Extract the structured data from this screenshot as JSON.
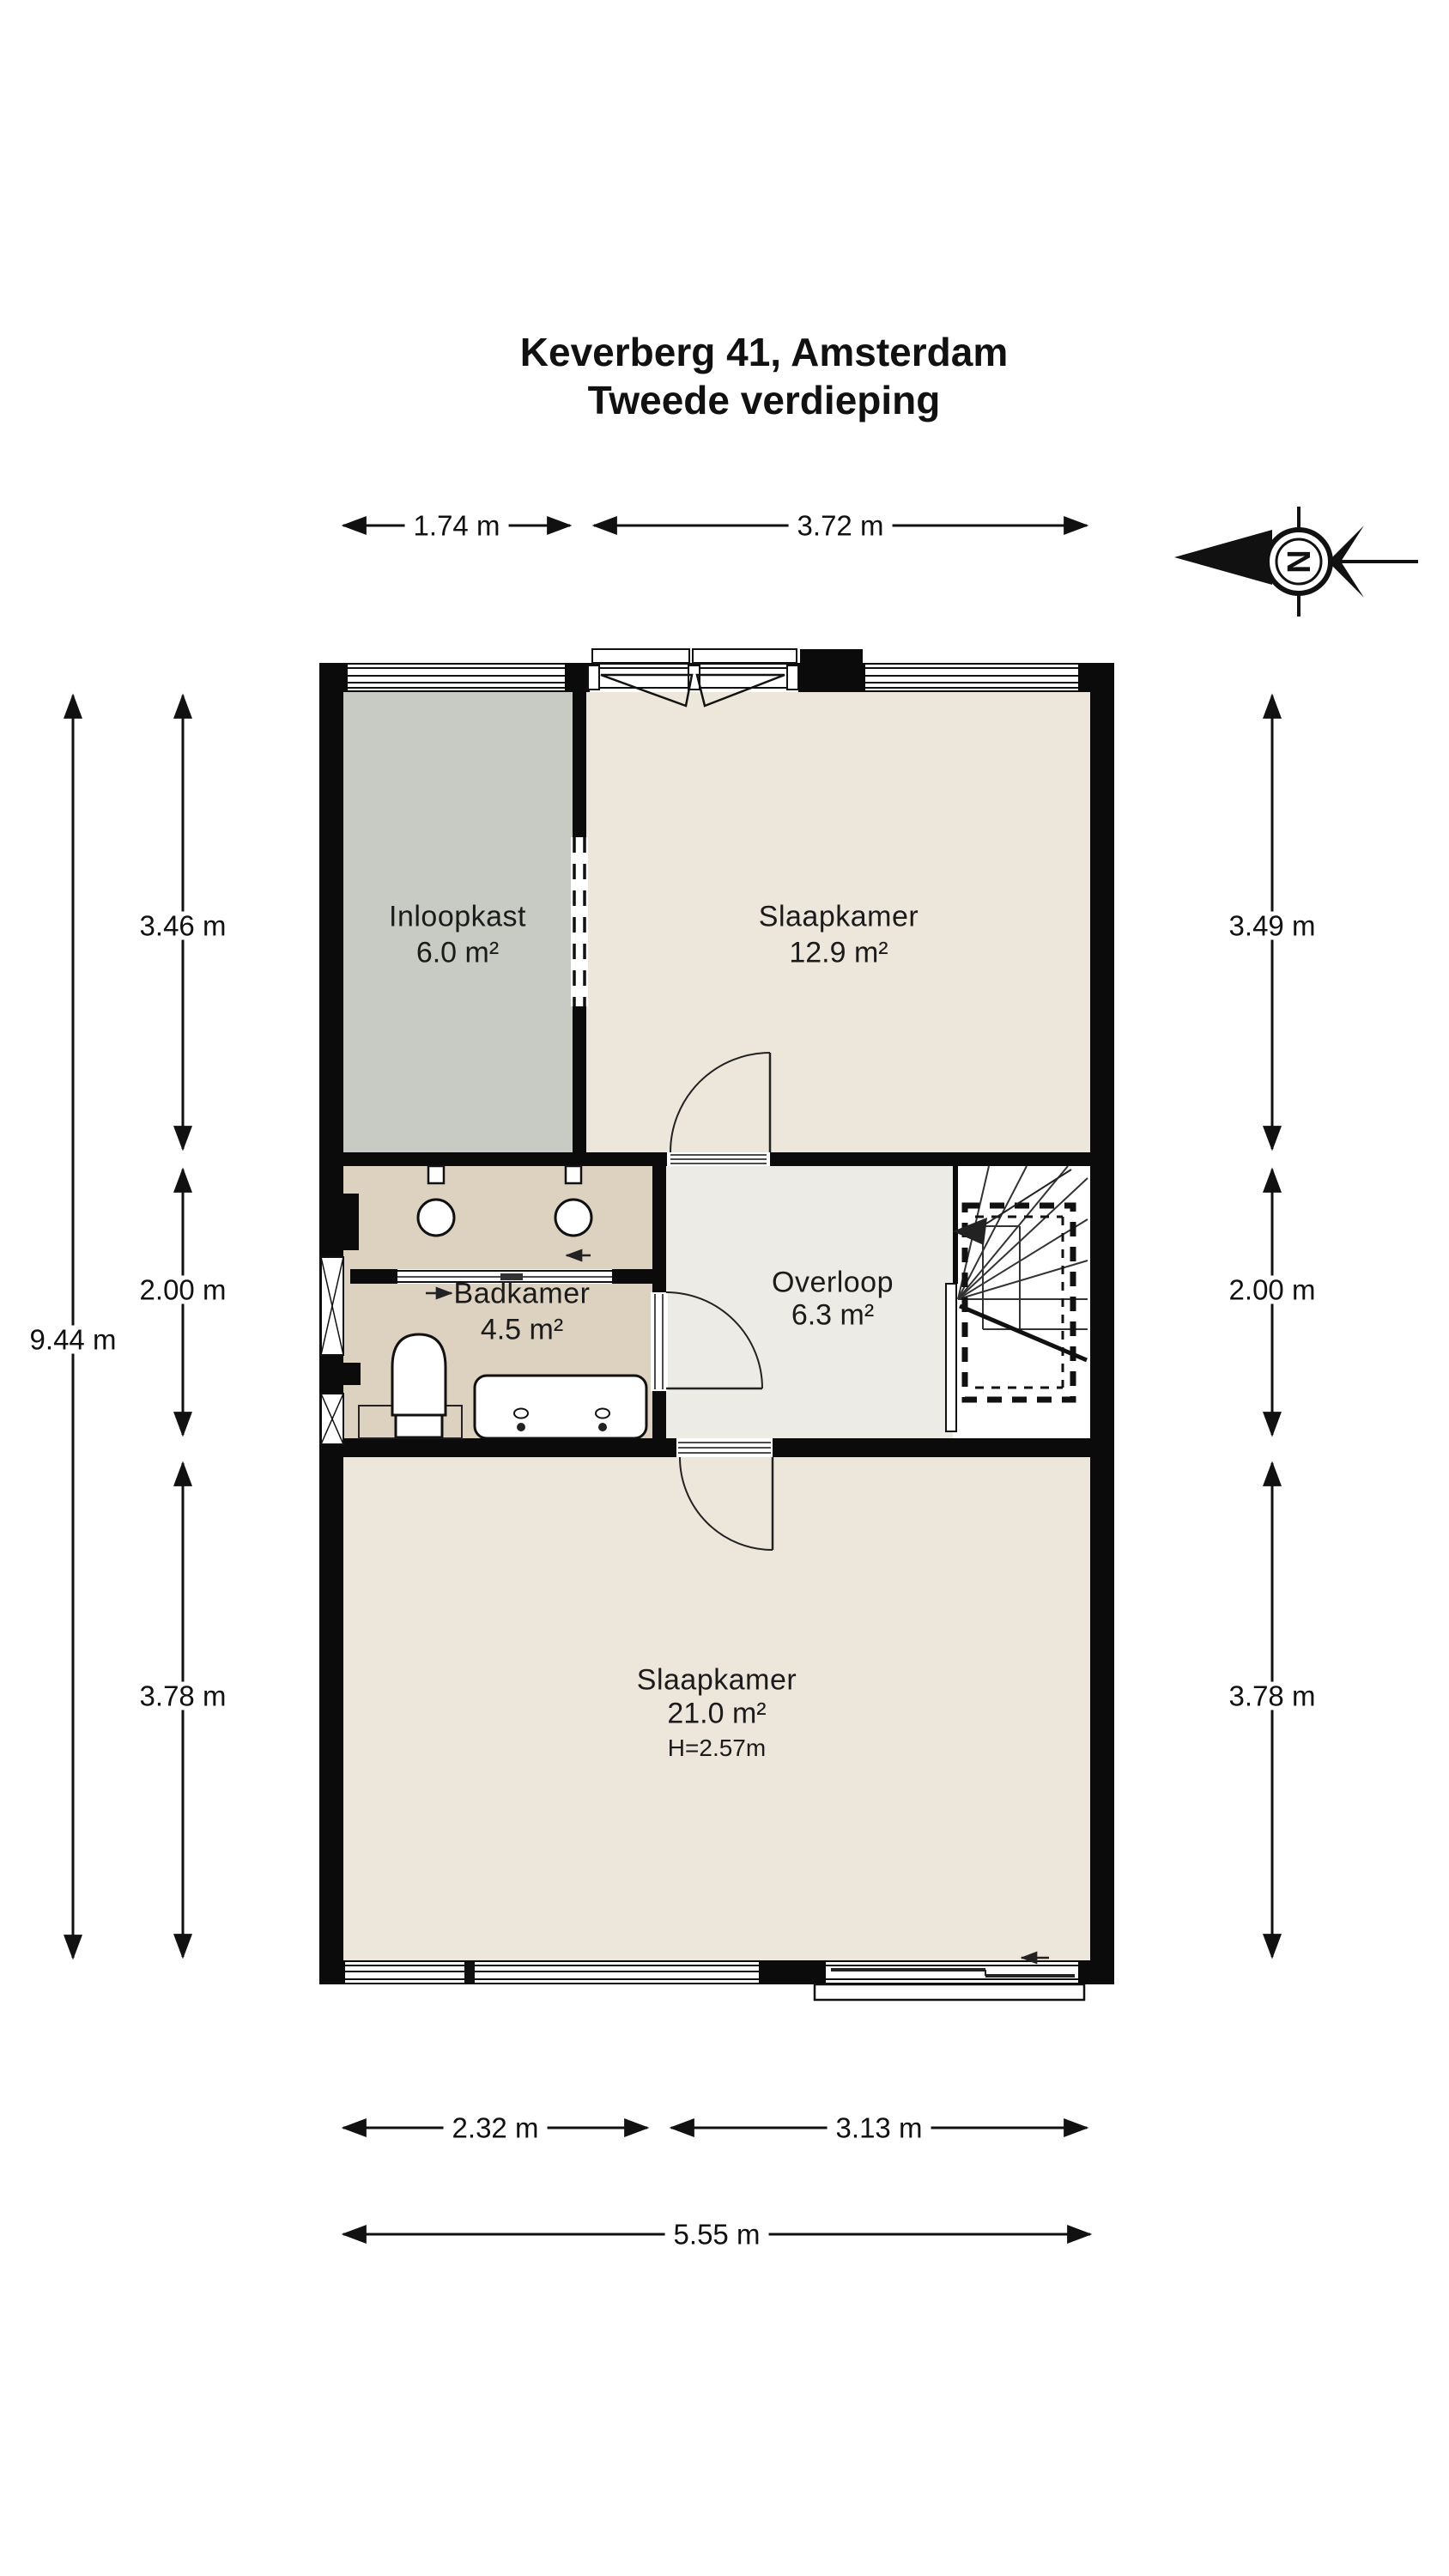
{
  "title": {
    "line1": "Keverberg 41, Amsterdam",
    "line2": "Tweede verdieping"
  },
  "compass": {
    "letter": "N"
  },
  "rooms": {
    "inloopkast": {
      "name": "Inloopkast",
      "area": "6.0 m²"
    },
    "slaapkamer_top": {
      "name": "Slaapkamer",
      "area": "12.9 m²"
    },
    "badkamer": {
      "name": "Badkamer",
      "area": "4.5 m²"
    },
    "overloop": {
      "name": "Overloop",
      "area": "6.3 m²"
    },
    "slaapkamer_bottom": {
      "name": "Slaapkamer",
      "area": "21.0 m²",
      "ceiling_height": "H=2.57m"
    }
  },
  "dimensions": {
    "top": [
      "1.74 m",
      "3.72 m"
    ],
    "left_total": "9.44 m",
    "left": [
      "3.46 m",
      "2.00 m",
      "3.78 m"
    ],
    "right": [
      "3.49 m",
      "2.00 m",
      "3.78 m"
    ],
    "bottom": [
      "2.32 m",
      "3.13 m"
    ],
    "bottom_total": "5.55 m"
  },
  "colors": {
    "wall": "#0b0b0b",
    "bedroom_floor": "#ece7da",
    "closet_floor": "#c7cbc3",
    "bathroom_floor": "#ddd1c0",
    "landing_floor": "#edebe5",
    "stairs_floor": "#ffffff"
  }
}
